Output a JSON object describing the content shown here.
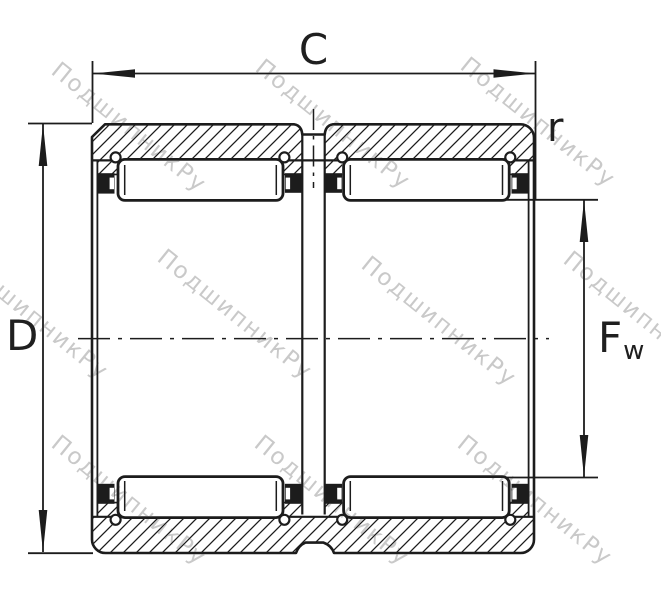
{
  "labels": {
    "width_dim": "C",
    "outer_diameter_dim": "D",
    "corner_radius_dim": "r",
    "raceway_diameter_main": "F",
    "raceway_diameter_sub": "w"
  },
  "watermark": {
    "text": "ПодшипникРу",
    "color": "#c9c9c9"
  },
  "colors": {
    "line": "#1c1c1c",
    "background": "#ffffff",
    "label": "#1f1f1f"
  }
}
